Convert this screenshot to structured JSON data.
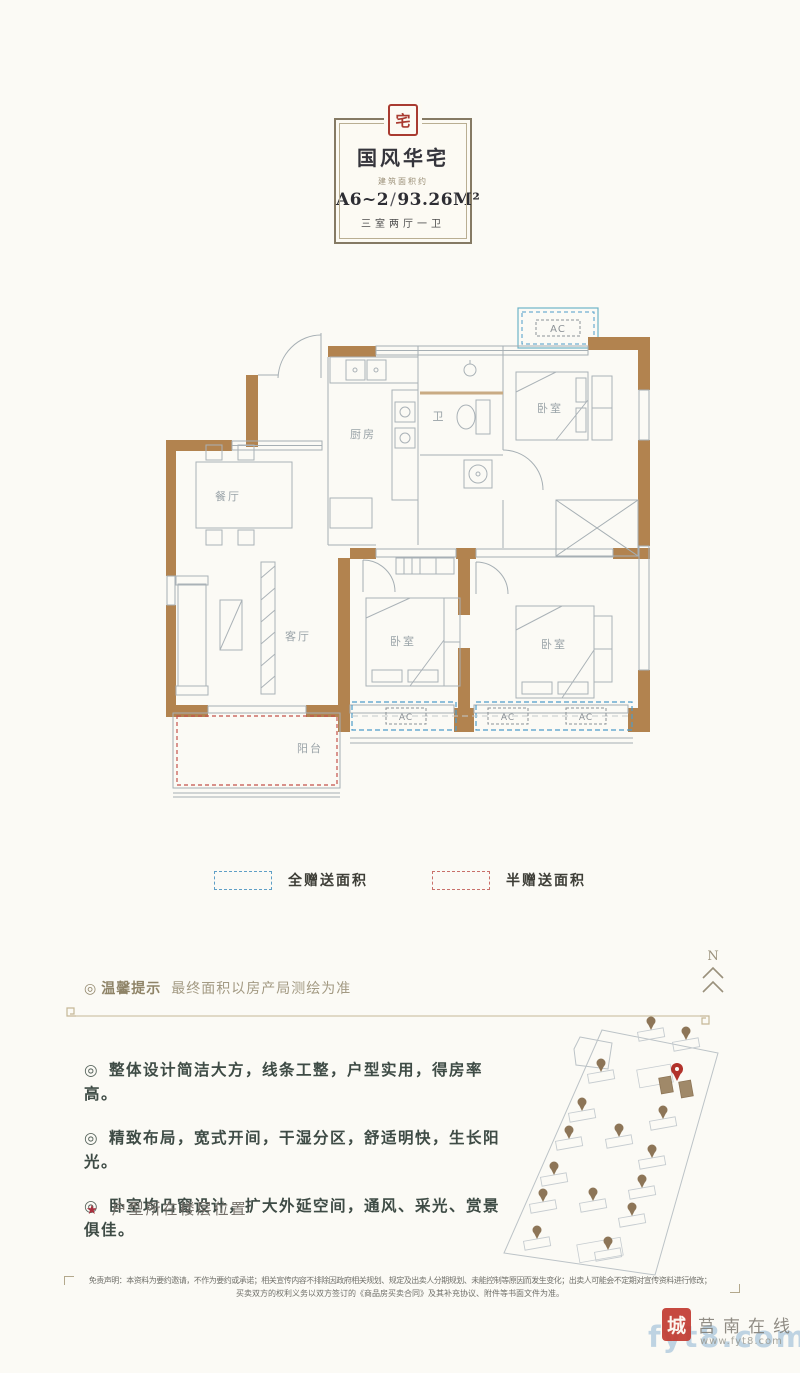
{
  "header": {
    "seal": "宅",
    "title": "国风华宅",
    "subtitle": "建筑面积约",
    "unit_code": "A6~2",
    "separator": "/",
    "area": "93.26M²",
    "rooms_desc": "三室两厅一卫"
  },
  "floorplan": {
    "labels": {
      "dining": "餐厅",
      "kitchen": "厨房",
      "bath": "卫",
      "living": "客厅",
      "bedroom1": "卧室",
      "bedroom2": "卧室",
      "bedroom3": "卧室",
      "balcony": "阳台"
    },
    "ac": "AC"
  },
  "legend": [
    {
      "label": "全赠送面积",
      "color": "#5f9fc6",
      "style": "blue-dashed"
    },
    {
      "label": "半赠送面积",
      "color": "#c9706a",
      "style": "red-dashed"
    }
  ],
  "compass": {
    "label": "N"
  },
  "tip": {
    "bullet": "◎",
    "title": "温馨提示",
    "text": "最终面积以房产局测绘为准"
  },
  "features": {
    "bullet": "◎",
    "items": [
      "整体设计简洁大方，线条工整，户型实用，得房率高。",
      "精致布局，宽式开间，干湿分区，舒适明快，生长阳光。",
      "卧室均凸窗设计，扩大外延空间，通风、采光、赏景俱佳。"
    ]
  },
  "floor_location": {
    "star": "★",
    "label": "户型所在楼层位置"
  },
  "disclaimer": {
    "line1": "免责声明：本资料为要约邀请，不作为要约或承诺；相关宣传内容不排除因政府相关规划、规定及出卖人分期规划、未能控制等原因而发生变化；出卖人可能会不定期对宣传资料进行修改；",
    "line2": "买卖双方的权利义务以双方签订的《商品房买卖合同》及其补充协议、附件等书面文件为准。"
  },
  "watermark": {
    "seal": "城",
    "site": "莒南在线",
    "url": "www.fyt8.com",
    "overlay": "fyt8.com"
  },
  "colors": {
    "wall": "#b2834f",
    "plan_line": "#a6afb4",
    "gift_full_blue": "#4e9cc9",
    "gift_half_red": "#c4524a",
    "seal_red": "#a93b30"
  }
}
